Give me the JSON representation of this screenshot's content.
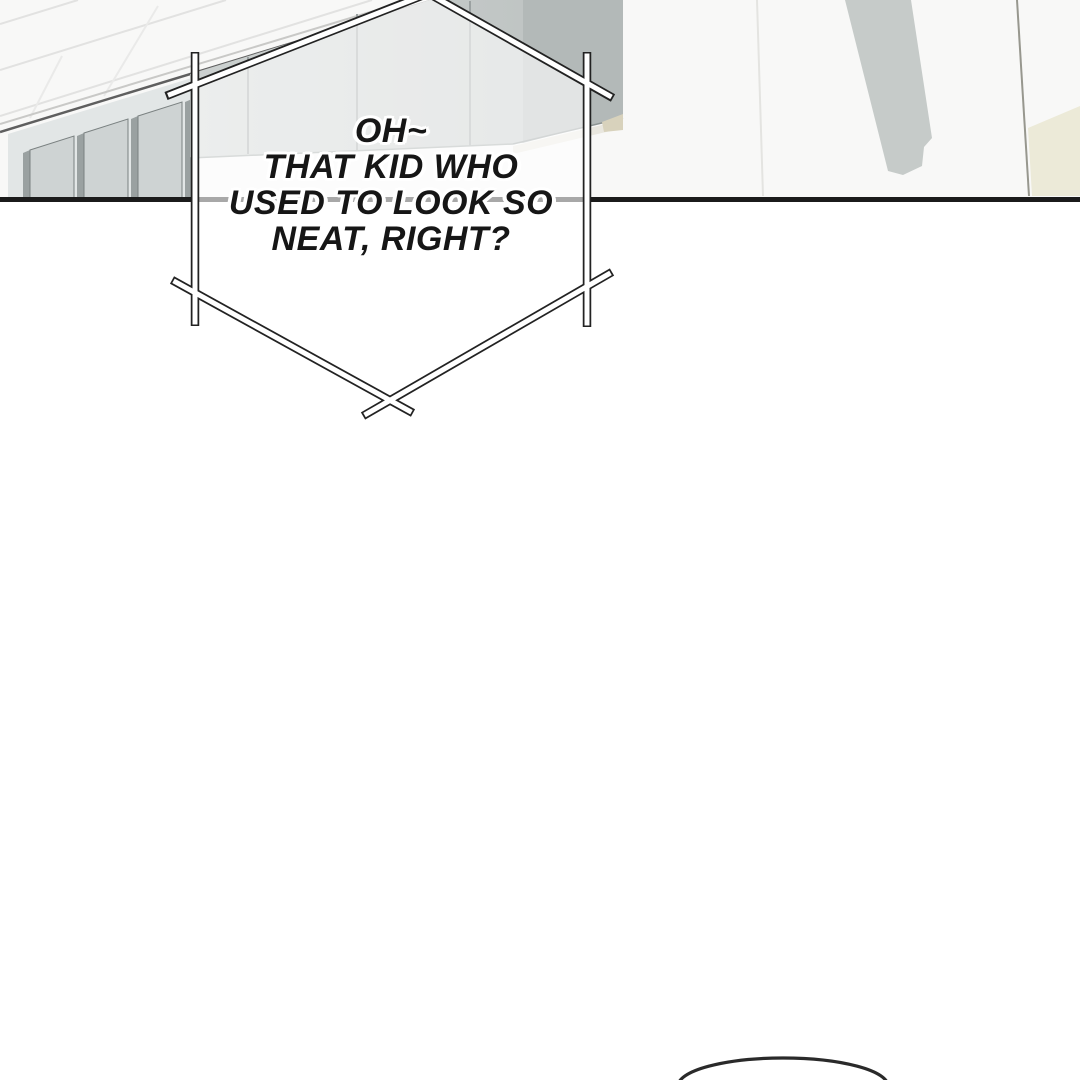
{
  "panel": {
    "speech_bubble": {
      "shape": "spiky-hexagon-frame",
      "lines": [
        "OH~",
        "THAT KID WHO",
        "USED TO LOOK SO",
        "NEAT, RIGHT?"
      ]
    },
    "next_bubble": {
      "visible": true,
      "note": "top arc of a round speech bubble entering from bottom edge"
    },
    "colors": {
      "ink": "#1b1b1b",
      "paper": "#ffffff",
      "wall": "#f8f8f7",
      "locker_front": "#c7cccb",
      "locker_seam": "#9ba1a1",
      "locker_side": "#b3b9b8",
      "partition_slat": "#ced3d3",
      "partition_edge": "#9aa1a1",
      "trim": "#e9e7df",
      "beige_accent": "#ecead8",
      "hanging_cloth": "#c6cbc9",
      "bubble_fill": "rgba(255,255,255,0.62)"
    }
  }
}
